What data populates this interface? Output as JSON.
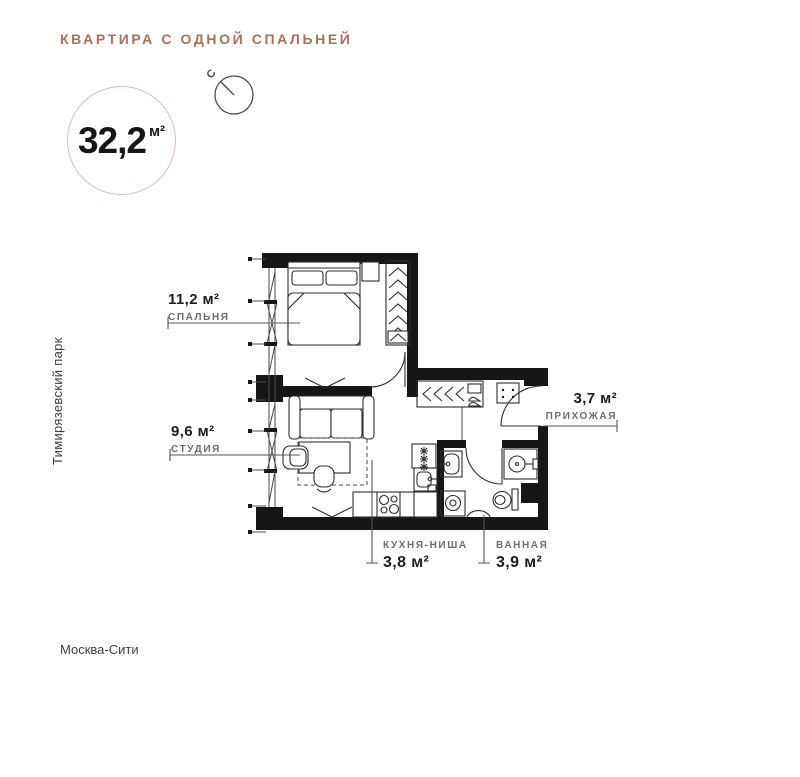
{
  "header": {
    "title": "КВАРТИРА С ОДНОЙ СПАЛЬНЕЙ"
  },
  "area_badge": {
    "value": "32,2",
    "unit": "м²"
  },
  "compass": {
    "north_label": "С"
  },
  "map_labels": {
    "park": "Тимирязевский парк",
    "city": "Москва-Сити"
  },
  "rooms": [
    {
      "id": "bedroom",
      "area": "11,2 м²",
      "name": "СПАЛЬНЯ"
    },
    {
      "id": "studio",
      "area": "9,6 м²",
      "name": "СТУДИЯ"
    },
    {
      "id": "hallway",
      "area": "3,7 м²",
      "name": "ПРИХОЖАЯ"
    },
    {
      "id": "kitchen",
      "area": "3,8 м²",
      "name": "КУХНЯ-НИША"
    },
    {
      "id": "bathroom",
      "area": "3,9 м²",
      "name": "ВАННАЯ"
    }
  ],
  "colors": {
    "accent": "#A8705C",
    "badge_circle_stroke": "#DCBBAD",
    "plan_ink": "#161616",
    "label_gray": "#6D6D6D"
  }
}
